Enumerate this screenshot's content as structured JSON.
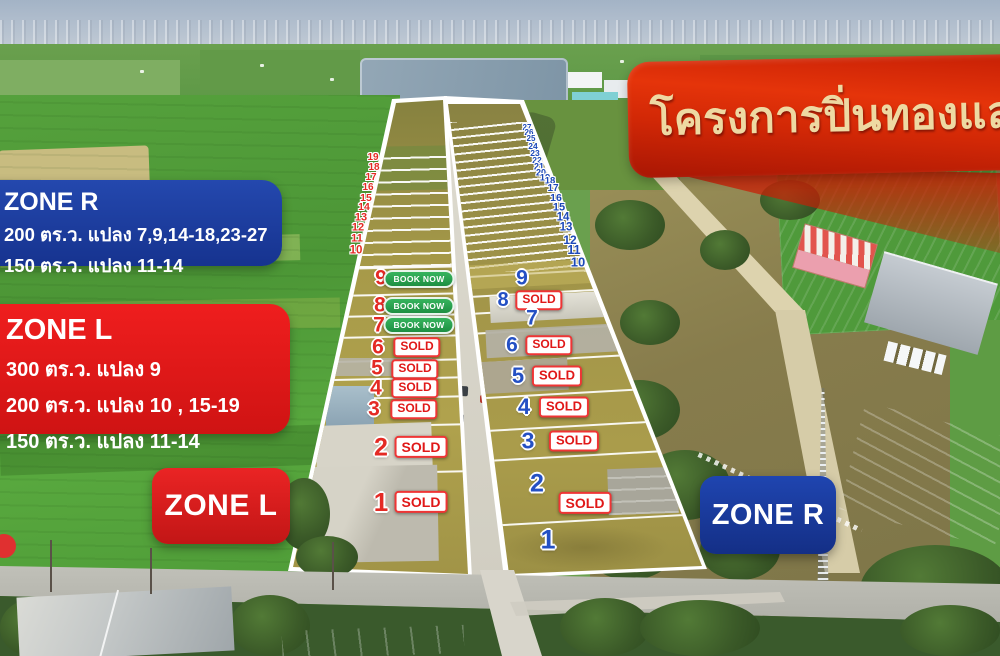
{
  "banner": {
    "title": "โครงการปิ่นทองแลนด์"
  },
  "info_boxes": {
    "zone_r": {
      "title": "ZONE R",
      "lines": [
        "200 ตร.ว. แปลง 7,9,14-18,23-27",
        "150 ตร.ว.  แปลง 11-14"
      ]
    },
    "zone_l": {
      "title": "ZONE L",
      "lines": [
        "300 ตร.ว. แปลง 9",
        "200 ตร.ว. แปลง 10 , 15-19",
        "150 ตร.ว.  แปลง 11-14"
      ]
    }
  },
  "zone_badges": {
    "left": "ZONE L",
    "right": "ZONE R"
  },
  "plots": {
    "left_large": [
      {
        "num": "9",
        "label": "BOOK NOW",
        "status": "book"
      },
      {
        "num": "8",
        "label": "BOOK NOW",
        "status": "book"
      },
      {
        "num": "7",
        "label": "BOOK NOW",
        "status": "book"
      },
      {
        "num": "6",
        "label": "SOLD",
        "status": "sold"
      },
      {
        "num": "5",
        "label": "SOLD",
        "status": "sold"
      },
      {
        "num": "4",
        "label": "SOLD",
        "status": "sold"
      },
      {
        "num": "3",
        "label": "SOLD",
        "status": "sold"
      },
      {
        "num": "2",
        "label": "SOLD",
        "status": "sold"
      },
      {
        "num": "1",
        "label": "SOLD",
        "status": "sold"
      }
    ],
    "right_large": [
      {
        "num": "9",
        "label": "",
        "status": "none"
      },
      {
        "num": "8",
        "label": "SOLD",
        "status": "sold"
      },
      {
        "num": "7",
        "label": "",
        "status": "none"
      },
      {
        "num": "6",
        "label": "SOLD",
        "status": "sold"
      },
      {
        "num": "5",
        "label": "SOLD",
        "status": "sold"
      },
      {
        "num": "4",
        "label": "SOLD",
        "status": "sold"
      },
      {
        "num": "3",
        "label": "SOLD",
        "status": "sold"
      },
      {
        "num": "2",
        "label": "SOLD",
        "status": "sold"
      },
      {
        "num": "1",
        "label": "",
        "status": "none"
      }
    ],
    "left_small": [
      "19",
      "18",
      "17",
      "16",
      "15",
      "14",
      "13",
      "12",
      "11",
      "10"
    ],
    "right_small": [
      "27",
      "26",
      "25",
      "24",
      "23",
      "22",
      "21",
      "20",
      "19",
      "18",
      "17",
      "16",
      "15",
      "14",
      "13",
      "12",
      "11",
      "10"
    ]
  },
  "colors": {
    "zone_red": "#e02020",
    "zone_blue": "#1b3fa5",
    "sold_red": "#e01818",
    "book_green": "#27a04b",
    "banner_red": "#d42408",
    "banner_text": "#eed9a2"
  }
}
